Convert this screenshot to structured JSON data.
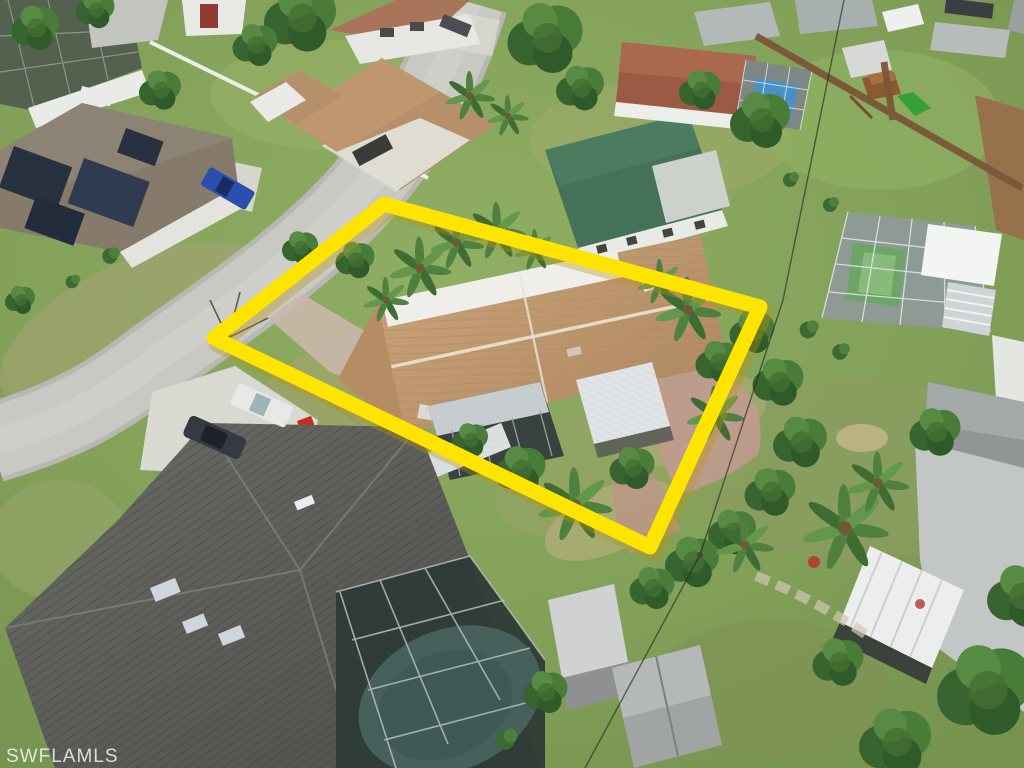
{
  "photo": {
    "type": "aerial-drone-photo",
    "description": "Oblique aerial view of a suburban Florida neighborhood; one lot is outlined with a thick yellow boundary",
    "watermark": {
      "text": "SWFLAMLS"
    },
    "boundary": {
      "color": "#FFE400",
      "shape": "rotated-rectangle"
    },
    "visible_features": {
      "subject_property": "single-story house with tan shingle roof, white roof stripe, screened lanai, metal awning, pink paver drive, many palms",
      "neighbors": [
        "house with rooftop solar panels and blue pickup (upper left)",
        "tan-roof ranch house with carport (top center)",
        "green shingle roof house (top center-right)",
        "terracotta-roof house with blue pool in screen cage (top right)",
        "large pool screen enclosure with green court and wood playset (right)",
        "large dark-gray tile roof house with skylights and screened pool (foreground bottom left)",
        "gray storage sheds (bottom center)",
        "gray-roof house with white corrugated awning (bottom right)"
      ],
      "road": "light gray street running diagonally from left edge toward top",
      "vehicles": [
        "blue pickup",
        "white pickup",
        "dark sedan",
        "dark car at top",
        "dark car at top right",
        "red ATV"
      ]
    },
    "palette": {
      "grass": "#85a35c",
      "dry_grass": "#b0a878",
      "road": "#c7c8c2",
      "concrete": "#d8d8d1",
      "subject_roof": "#bd9770",
      "foreground_roof": "#5d5d59",
      "green_roof": "#47725a",
      "terracotta_roof": "#9c5a44",
      "pool_blue": "#4a90c8",
      "screen_dark": "#39423f",
      "fence_wood": "#7b5638"
    }
  }
}
